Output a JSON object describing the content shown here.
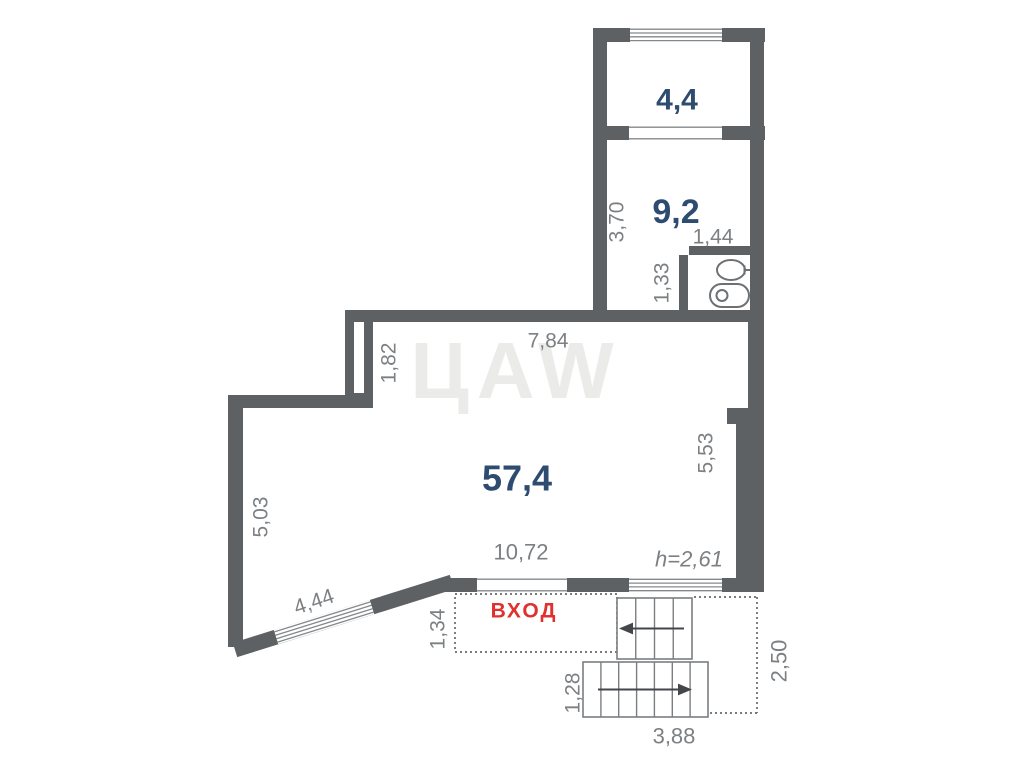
{
  "plan": {
    "watermark": {
      "text": "ЦAW"
    },
    "rooms": {
      "top": {
        "area": "4,4"
      },
      "middle": {
        "area": "9,2"
      },
      "main": {
        "area": "57,4"
      }
    },
    "entrance": {
      "label": "ВХОД"
    },
    "dims": {
      "v3_70": "3,70",
      "v1_44": "1,44",
      "v1_33": "1,33",
      "v1_82": "1,82",
      "v7_84": "7,84",
      "v5_53": "5,53",
      "v5_03": "5,03",
      "v10_72": "10,72",
      "height": "h=2,61",
      "v4_44": "4,44",
      "v1_34": "1,34",
      "v1_28": "1,28",
      "v3_88": "3,88",
      "v2_50": "2,50"
    },
    "colors": {
      "wall": "#5d6164",
      "room_label": "#2e4c70",
      "entrance": "#e0312e",
      "dimension": "#7d8083",
      "background": "#ffffff"
    }
  }
}
